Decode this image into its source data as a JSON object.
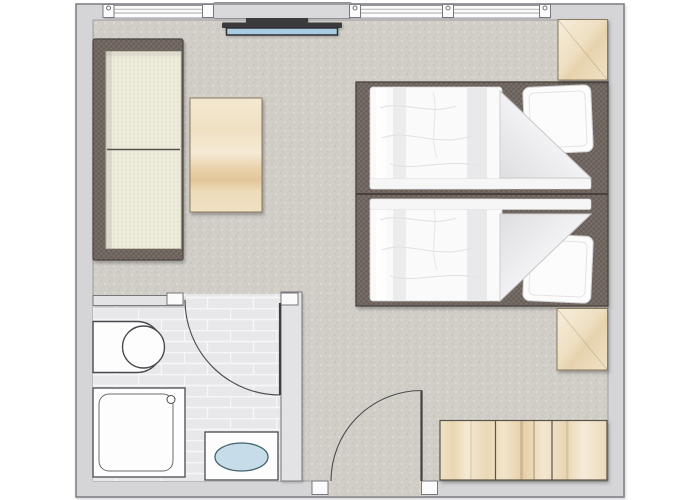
{
  "meta": {
    "title": "Hotel room floor plan",
    "view": "top-down 2D plan",
    "rooms": [
      {
        "name": "bedroom-living-area",
        "floor": "carpet"
      },
      {
        "name": "bathroom",
        "floor": "ceramic-tile"
      }
    ]
  },
  "inventory": {
    "windows": {
      "count": 3,
      "wall": "top"
    },
    "wall_pier": {
      "label": "wall pier / sill panel"
    },
    "tv": {
      "label": "flat-screen TV"
    },
    "sofa": {
      "label": "two-seat sofa"
    },
    "coffee_table": {
      "label": "coffee table"
    },
    "beds": {
      "label": "twin beds",
      "count": 2
    },
    "pillows": {
      "count": 2
    },
    "nightstands": {
      "count": 2
    },
    "wardrobe": {
      "label": "wardrobe",
      "doors": 3
    },
    "entry_door": {
      "label": "entrance door",
      "swing": "inward"
    },
    "bathroom_door": {
      "label": "bathroom door",
      "swing": "into bathroom"
    },
    "toilet": {
      "label": "toilet"
    },
    "shower": {
      "label": "shower tray with drain"
    },
    "washbasin": {
      "label": "washbasin with blue bowl"
    }
  },
  "palette": {
    "page_bg": "#ffffff",
    "wall_fill": "#d5d5d7",
    "wall_line": "#86868b",
    "window_white": "#fbfbfb",
    "slab": "#d9d9db",
    "carpet": "#d1cec8",
    "tile": "#e8e8ea",
    "grout": "#f7f7f8",
    "dark_wood": "#6f655f",
    "dark_wood_line": "#4a423c",
    "cushion": "#efeedd",
    "cushion_line": "#55514b",
    "wood_line": "#8a7a5f",
    "wardrobe_line": "#5a5248",
    "white_fabric": "#fafafa",
    "fabric_line": "#d2d2d5",
    "fold_shade": "#dedee1",
    "tv_dark": "#3a3a3c",
    "tv_screen": "#a8cde2",
    "tv_screen_line": "#2e2e30",
    "water_blue": "#c6dce9",
    "water_line": "#44616f",
    "fixture_white": "#fdfdfe",
    "fixture_line": "#4a4a4e",
    "partition": "#e3e3e5",
    "partition_line": "#77777b",
    "door_line": "#3f3f41"
  }
}
